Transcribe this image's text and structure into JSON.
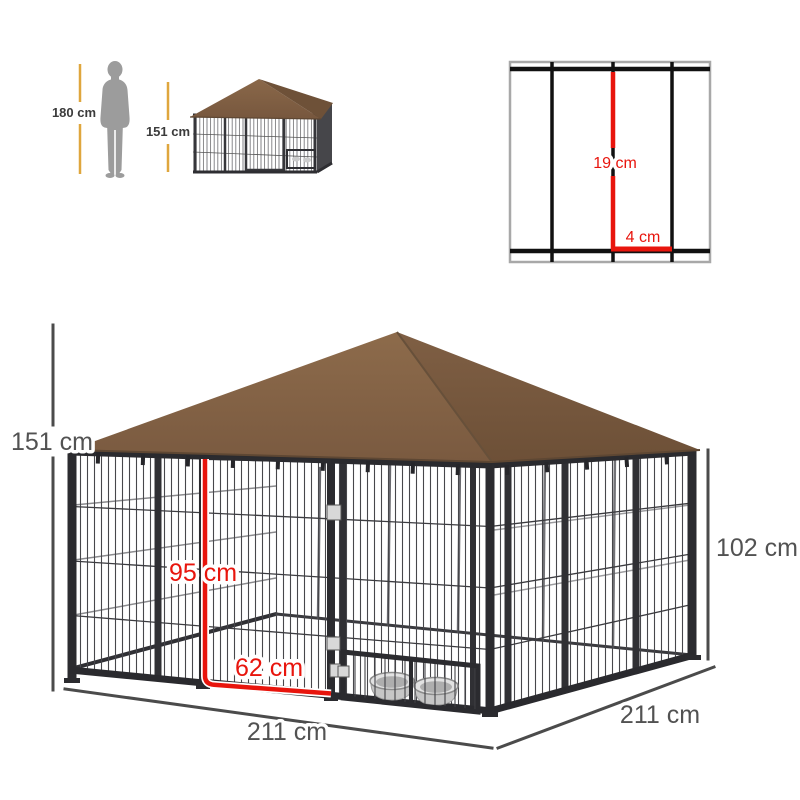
{
  "scale_reference": {
    "person_height": "180 cm",
    "thumbnail_height": "151 cm"
  },
  "mesh_detail": {
    "vertical_spacing": "19 cm",
    "horizontal_spacing": "4 cm"
  },
  "dimensions": {
    "overall_height": "151 cm",
    "wall_height": "102 cm",
    "front_width": "211 cm",
    "side_depth": "211 cm",
    "door_height": "95 cm",
    "door_width": "62 cm"
  },
  "icons": {
    "person": "person-silhouette",
    "bowls": "dog-feeding-bowls"
  },
  "colors": {
    "canopy_brown": "#84634a",
    "canopy_brown_dark": "#6f5238",
    "frame_black": "#2b2b2f",
    "dimension_gray": "#525252",
    "dimension_red": "#e8150d",
    "scale_line_yellow": "#dfa63d",
    "silhouette_gray": "#9c9c9c"
  }
}
